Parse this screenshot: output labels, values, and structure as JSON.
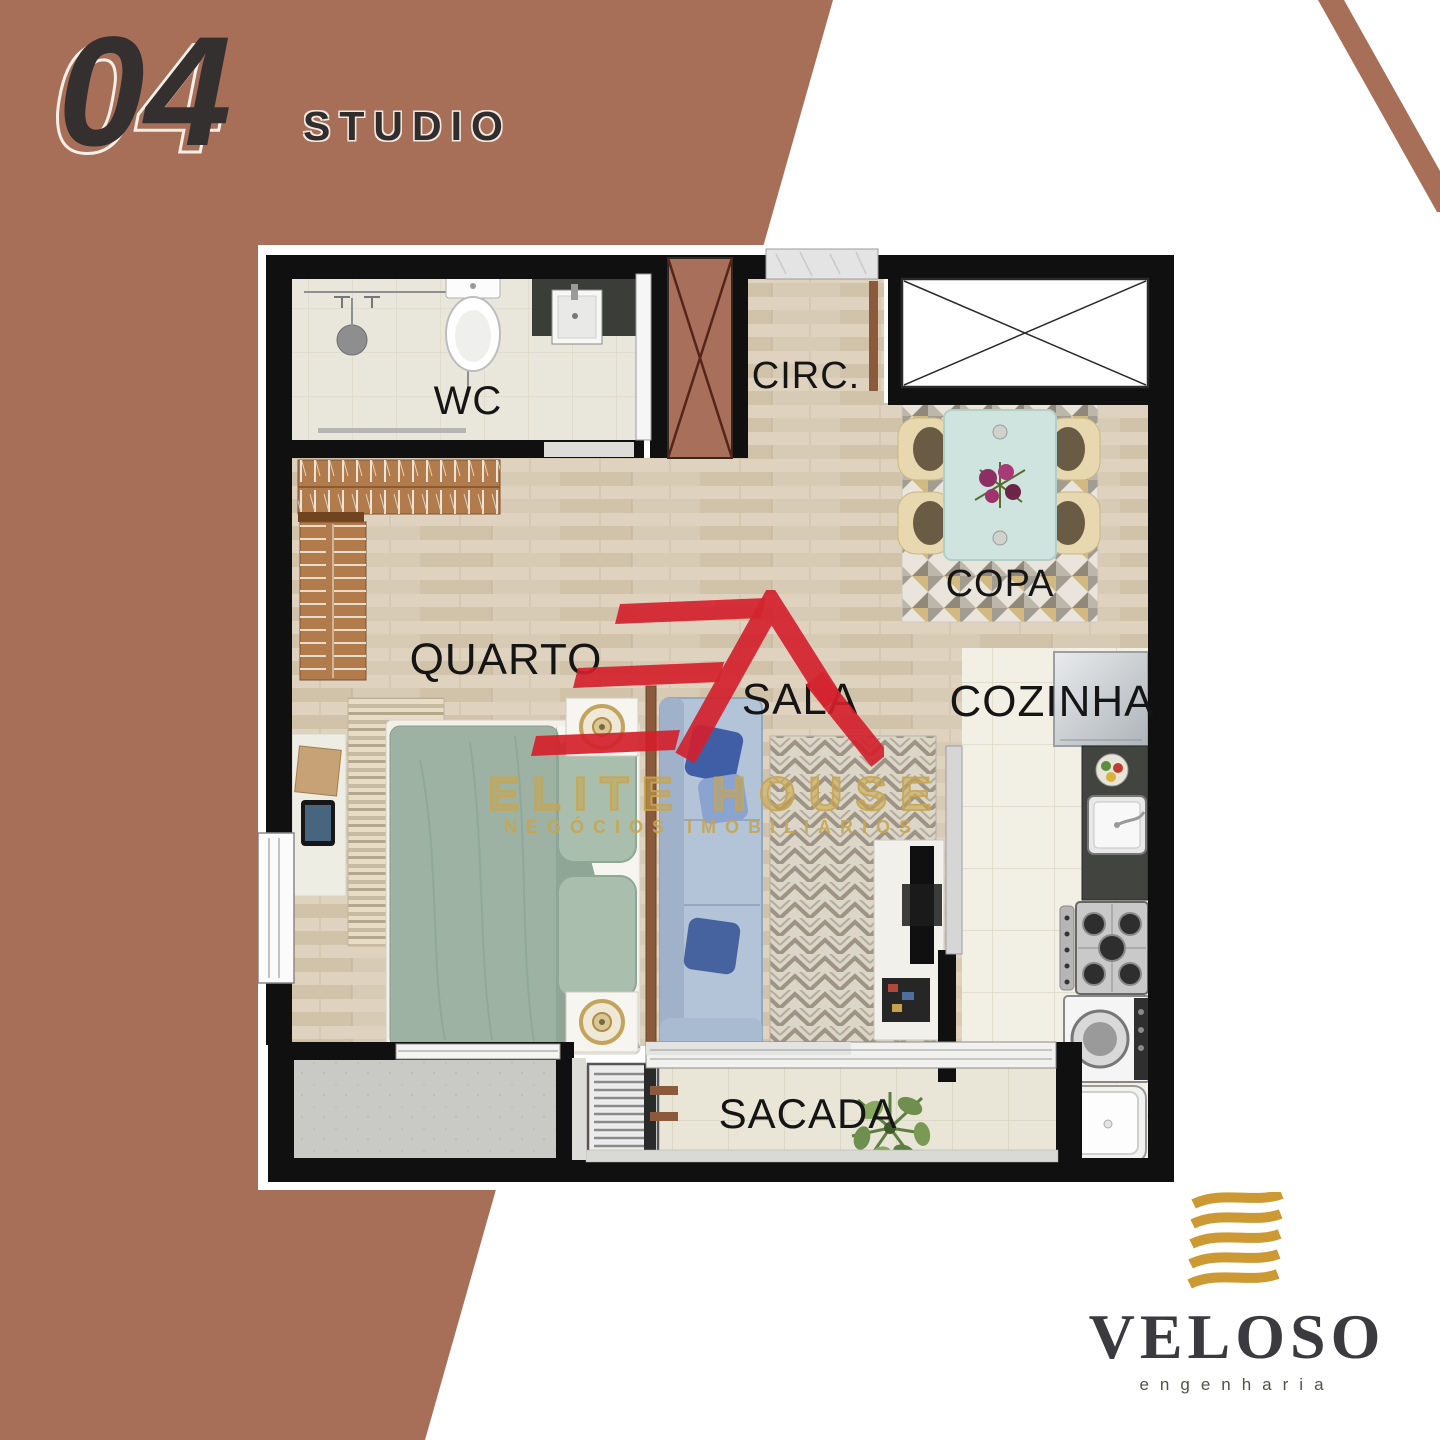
{
  "header": {
    "unit_number": "04",
    "unit_type": "STUDIO"
  },
  "floor_plan": {
    "rooms": {
      "wc": "WC",
      "circulation": "CIRC.",
      "dining": "COPA",
      "bedroom": "QUARTO",
      "living": "SALA",
      "kitchen": "COZINHA",
      "balcony": "SACADA"
    }
  },
  "watermark": {
    "brand": "ELITE HOUSE",
    "tagline": "NEGÓCIOS IMOBILIÁRIOS"
  },
  "developer": {
    "name": "VELOSO",
    "tagline": "engenharia"
  },
  "colors": {
    "terracotta": "#a76f58",
    "wall_black": "#111111",
    "brand_red": "#d4202c",
    "brand_gold": "#c7a24f",
    "wood_floor": "#d8cbb6",
    "tile_floor": "#f2f0e5"
  }
}
